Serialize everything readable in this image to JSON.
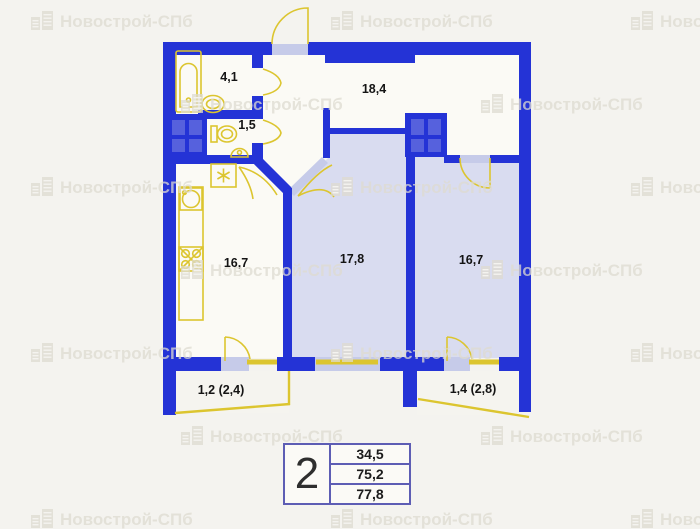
{
  "watermark": {
    "text": "Новострой-СПб",
    "icon": "building-icon"
  },
  "plan": {
    "rooms": [
      {
        "name": "bathroom",
        "area": "4,1"
      },
      {
        "name": "wc",
        "area": "1,5"
      },
      {
        "name": "hallway",
        "area": "18,4"
      },
      {
        "name": "kitchen",
        "area": "16,7"
      },
      {
        "name": "living-room",
        "area": "17,8"
      },
      {
        "name": "bedroom",
        "area": "16,7"
      },
      {
        "name": "balcony-left",
        "area": "1,2 (2,4)"
      },
      {
        "name": "balcony-right",
        "area": "1,4 (2,8)"
      }
    ]
  },
  "summary_table": {
    "rooms_count": "2",
    "row1": "34,5",
    "row2": "75,2",
    "row3": "77,8"
  },
  "colors": {
    "wall": "#2433d6",
    "room_fill": "#d9dcf0",
    "threshold_fill": "#c6cbe9",
    "fixture_yellow": "#dcc52f",
    "shaft_inner": "#5661dd",
    "background": "#f4f3ef",
    "table_border": "#5d5db4"
  }
}
